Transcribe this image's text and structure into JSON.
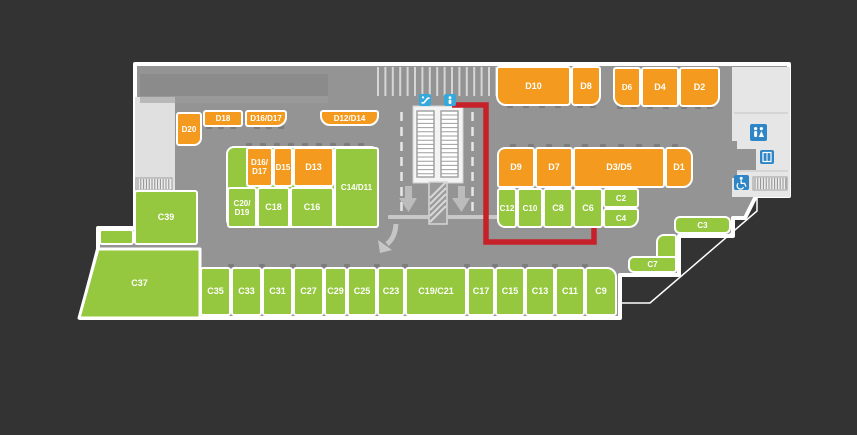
{
  "map": {
    "title": "shopping-centre-parking-level-floor-plan",
    "colors": {
      "background": "#333333",
      "floor": "#949494",
      "orange_unit": "#F49A1E",
      "green_unit": "#95C83E",
      "outline_white": "#FFFFFF",
      "light_area": "#E3E3E3",
      "route_red": "#C6202A",
      "icon_blue_top": "#35A8DC",
      "icon_blue_room": "#2E86C6"
    },
    "units": [
      {
        "label": "D10",
        "x": 496,
        "y": 66,
        "w": 75,
        "h": 40,
        "c": "o",
        "r": "3px 3px 4px 10px"
      },
      {
        "label": "D8",
        "x": 571,
        "y": 66,
        "w": 30,
        "h": 40,
        "c": "o",
        "r": "3px 3px 10px 4px"
      },
      {
        "label": "D6",
        "x": 613,
        "y": 67,
        "w": 28,
        "h": 40,
        "c": "o",
        "r": "3px 3px 4px 10px",
        "fs": 8
      },
      {
        "label": "D4",
        "x": 641,
        "y": 67,
        "w": 38,
        "h": 40,
        "c": "o",
        "r": "3px"
      },
      {
        "label": "D2",
        "x": 679,
        "y": 67,
        "w": 41,
        "h": 40,
        "c": "o",
        "r": "3px 3px 10px 4px"
      },
      {
        "label": "D20",
        "x": 176,
        "y": 112,
        "w": 26,
        "h": 34,
        "c": "o",
        "r": "3px 3px 8px 3px",
        "fs": 8
      },
      {
        "label": "D18",
        "x": 203,
        "y": 110,
        "w": 40,
        "h": 17,
        "c": "o",
        "r": "3px",
        "fs": 8
      },
      {
        "label": "D16/D17",
        "x": 245,
        "y": 110,
        "w": 42,
        "h": 17,
        "c": "o",
        "r": "3px 3px 10px 3px",
        "fs": 8
      },
      {
        "label": "D12/D14",
        "x": 320,
        "y": 110,
        "w": 59,
        "h": 16,
        "c": "o",
        "r": "3px 3px 10px 10px",
        "fs": 8
      },
      {
        "label": "",
        "x": 226,
        "y": 146,
        "w": 153,
        "h": 82,
        "c": "g",
        "r": "8px"
      },
      {
        "label": "D16/\nD17",
        "x": 246,
        "y": 147,
        "w": 27,
        "h": 40,
        "c": "o",
        "r": "3px",
        "fs": 8
      },
      {
        "label": "D15",
        "x": 273,
        "y": 147,
        "w": 20,
        "h": 40,
        "c": "o",
        "r": "3px",
        "fs": 8
      },
      {
        "label": "D13",
        "x": 293,
        "y": 147,
        "w": 41,
        "h": 40,
        "c": "o",
        "r": "3px"
      },
      {
        "label": "C14/D11",
        "x": 334,
        "y": 147,
        "w": 45,
        "h": 81,
        "c": "g",
        "r": "3px",
        "fs": 8
      },
      {
        "label": "C20/\nD19",
        "x": 227,
        "y": 187,
        "w": 30,
        "h": 41,
        "c": "g",
        "r": "3px",
        "fs": 8
      },
      {
        "label": "C18",
        "x": 257,
        "y": 187,
        "w": 33,
        "h": 41,
        "c": "g",
        "r": "3px"
      },
      {
        "label": "C16",
        "x": 290,
        "y": 187,
        "w": 44,
        "h": 41,
        "c": "g",
        "r": "3px"
      },
      {
        "label": "D9",
        "x": 497,
        "y": 147,
        "w": 38,
        "h": 41,
        "c": "o",
        "r": "8px 3px 3px 3px"
      },
      {
        "label": "D7",
        "x": 535,
        "y": 147,
        "w": 38,
        "h": 41,
        "c": "o",
        "r": "3px"
      },
      {
        "label": "D3/D5",
        "x": 573,
        "y": 147,
        "w": 92,
        "h": 41,
        "c": "o",
        "r": "3px"
      },
      {
        "label": "D1",
        "x": 665,
        "y": 147,
        "w": 28,
        "h": 41,
        "c": "o",
        "r": "3px 10px 10px 3px"
      },
      {
        "label": "C12",
        "x": 497,
        "y": 188,
        "w": 20,
        "h": 40,
        "c": "g",
        "r": "3px 3px 3px 8px",
        "fs": 8
      },
      {
        "label": "C10",
        "x": 517,
        "y": 188,
        "w": 26,
        "h": 40,
        "c": "g",
        "r": "3px",
        "fs": 8
      },
      {
        "label": "C8",
        "x": 543,
        "y": 188,
        "w": 30,
        "h": 40,
        "c": "g",
        "r": "3px"
      },
      {
        "label": "C6",
        "x": 573,
        "y": 188,
        "w": 30,
        "h": 40,
        "c": "g",
        "r": "3px"
      },
      {
        "label": "C2",
        "x": 603,
        "y": 188,
        "w": 36,
        "h": 20,
        "c": "g",
        "r": "3px",
        "fs": 8
      },
      {
        "label": "C4",
        "x": 603,
        "y": 208,
        "w": 36,
        "h": 20,
        "c": "g",
        "r": "3px 3px 10px 3px",
        "fs": 8
      },
      {
        "label": "C3",
        "x": 674,
        "y": 216,
        "w": 57,
        "h": 18,
        "c": "g",
        "r": "6px",
        "fs": 8
      },
      {
        "label": "",
        "x": 656,
        "y": 234,
        "w": 21,
        "h": 26,
        "c": "g",
        "r": "8px 3px 3px 3px"
      },
      {
        "label": "C7",
        "x": 628,
        "y": 256,
        "w": 49,
        "h": 17,
        "c": "g",
        "r": "6px 3px 3px 6px",
        "fs": 8
      },
      {
        "label": "C39",
        "x": 134,
        "y": 190,
        "w": 64,
        "h": 55,
        "c": "g",
        "r": "3px"
      },
      {
        "label": "",
        "x": 99,
        "y": 229,
        "w": 35,
        "h": 16,
        "c": "g",
        "r": "3px"
      },
      {
        "label": "C37",
        "x": 79,
        "y": 248,
        "w": 121,
        "h": 70,
        "c": "g",
        "r": "0px",
        "noborder": true,
        "clip": "polygon(19px 0px, 121px 0px, 121px 70px, 0px 70px)"
      },
      {
        "label": "C35",
        "x": 200,
        "y": 267,
        "w": 31,
        "h": 49,
        "c": "g",
        "r": "3px"
      },
      {
        "label": "C33",
        "x": 231,
        "y": 267,
        "w": 31,
        "h": 49,
        "c": "g",
        "r": "3px"
      },
      {
        "label": "C31",
        "x": 262,
        "y": 267,
        "w": 31,
        "h": 49,
        "c": "g",
        "r": "3px"
      },
      {
        "label": "C27",
        "x": 293,
        "y": 267,
        "w": 31,
        "h": 49,
        "c": "g",
        "r": "3px"
      },
      {
        "label": "C29",
        "x": 324,
        "y": 267,
        "w": 23,
        "h": 49,
        "c": "g",
        "r": "3px"
      },
      {
        "label": "C25",
        "x": 347,
        "y": 267,
        "w": 30,
        "h": 49,
        "c": "g",
        "r": "3px"
      },
      {
        "label": "C23",
        "x": 377,
        "y": 267,
        "w": 28,
        "h": 49,
        "c": "g",
        "r": "3px"
      },
      {
        "label": "C19/C21",
        "x": 405,
        "y": 267,
        "w": 62,
        "h": 49,
        "c": "g",
        "r": "3px"
      },
      {
        "label": "C17",
        "x": 467,
        "y": 267,
        "w": 28,
        "h": 49,
        "c": "g",
        "r": "3px"
      },
      {
        "label": "C15",
        "x": 495,
        "y": 267,
        "w": 30,
        "h": 49,
        "c": "g",
        "r": "3px"
      },
      {
        "label": "C13",
        "x": 525,
        "y": 267,
        "w": 30,
        "h": 49,
        "c": "g",
        "r": "3px"
      },
      {
        "label": "C11",
        "x": 555,
        "y": 267,
        "w": 30,
        "h": 49,
        "c": "g",
        "r": "3px"
      },
      {
        "label": "C9",
        "x": 585,
        "y": 267,
        "w": 32,
        "h": 49,
        "c": "g",
        "r": "3px 10px 3px 3px"
      }
    ],
    "route": {
      "points": "452,105 486,105 486,242 594,242 594,228",
      "color": "#C6202A",
      "from": "escalator-entry",
      "to": "C6"
    },
    "icons": [
      {
        "name": "escalator-icon",
        "x": 419,
        "y": 93
      },
      {
        "name": "lift-icon",
        "x": 444,
        "y": 93
      },
      {
        "name": "toilets-icon",
        "x": 750,
        "y": 124
      },
      {
        "name": "elevator-icon",
        "x": 760,
        "y": 150
      },
      {
        "name": "accessible-icon",
        "x": 734,
        "y": 175
      }
    ]
  }
}
